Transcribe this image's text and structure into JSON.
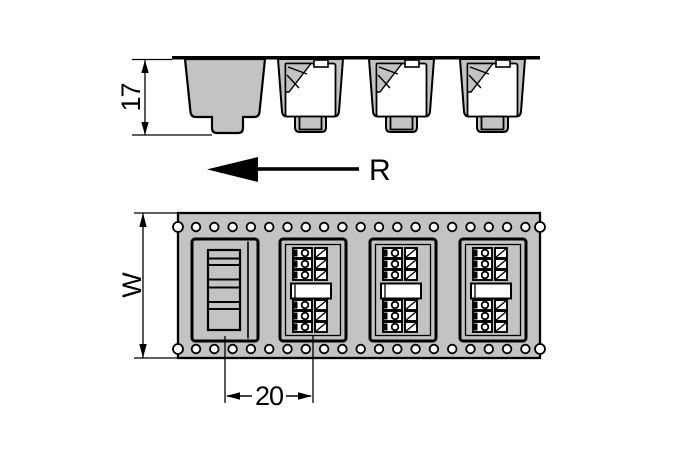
{
  "figure": {
    "labels": {
      "pocket_depth": "17",
      "unwind_direction": "R",
      "tape_width": "W",
      "component_pitch": "20"
    },
    "colors": {
      "tape_gray": "#c3c3c3",
      "line": "#000000",
      "background": "#ffffff"
    },
    "top_view": {
      "filled_pocket_xs": [
        278,
        369,
        460
      ],
      "pocket_y": 59
    },
    "bottom_view": {
      "filled_pocket_xs": [
        280,
        370,
        460
      ],
      "pocket_y": 239,
      "sprocket_holes": {
        "count": 19,
        "x_start": 196,
        "spacing": 18.3,
        "row_ys": [
          227,
          349
        ],
        "radius": 4.3
      },
      "edge_notches": {
        "xs": [
          178,
          540
        ],
        "ys": [
          227,
          349
        ],
        "radius": 5
      }
    }
  }
}
